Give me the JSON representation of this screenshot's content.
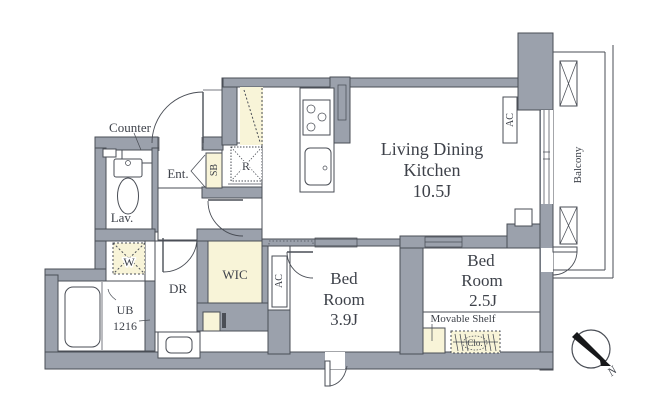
{
  "colors": {
    "wall": "#9ba1ac",
    "accent_tan": "#f8f4d8",
    "line": "#4a4e56",
    "text": "#3e424a"
  },
  "rooms": {
    "ldk": {
      "line1": "Living Dining",
      "line2": "Kitchen",
      "size": "10.5J"
    },
    "bedroom1": {
      "line1": "Bed",
      "line2": "Room",
      "size": "3.9J"
    },
    "bedroom2": {
      "line1": "Bed",
      "line2": "Room",
      "size": "2.5J"
    },
    "wic": "WIC",
    "balcony": "Balcony",
    "lavatory": "Lav.",
    "dressing_room": "DR",
    "entrance": "Ent.",
    "unit_bath": {
      "line1": "UB",
      "line2": "1216"
    }
  },
  "fixtures": {
    "counter": "Counter",
    "shoe_box": "SB",
    "refrigerator": "R",
    "air_conditioner": "AC",
    "washing_machine": "W",
    "movable_shelf": "Movable Shelf",
    "closet": "Clo."
  },
  "compass": {
    "north": "N"
  }
}
